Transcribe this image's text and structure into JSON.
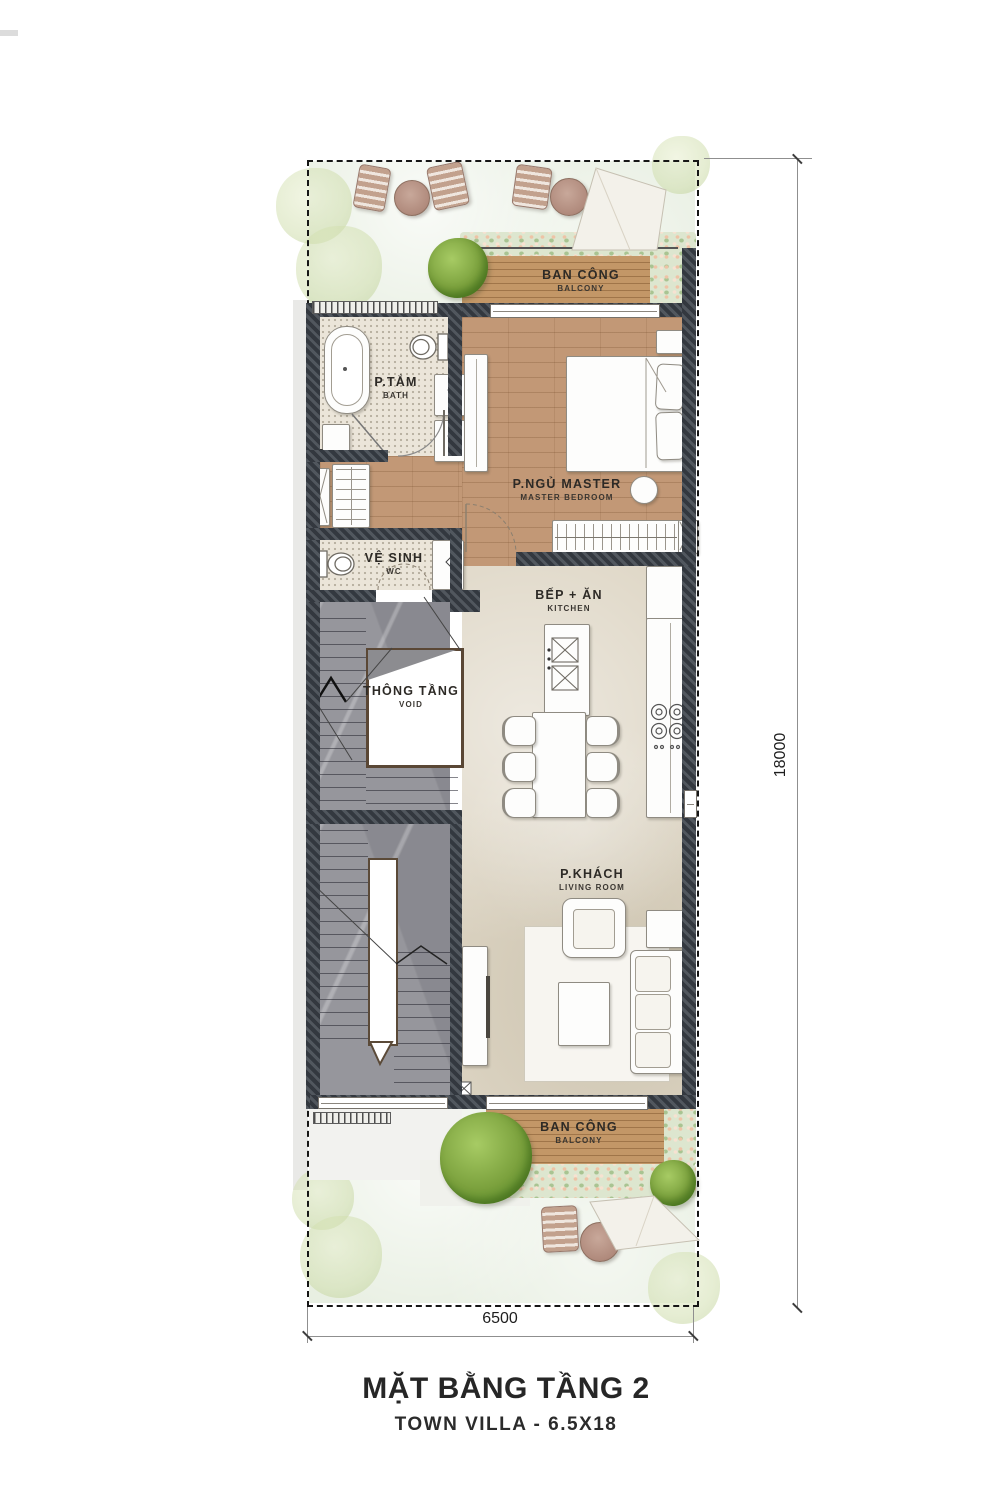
{
  "plan": {
    "title": "MẶT BẰNG TẦNG 2",
    "subtitle": "TOWN VILLA  - 6.5X18",
    "dim_width": "6500",
    "dim_height": "18000",
    "rooms": {
      "balcony_top": {
        "name": "BAN CÔNG",
        "name_en": "BALCONY"
      },
      "bath": {
        "name": "P.TẮM",
        "name_en": "BATH"
      },
      "master": {
        "name": "P.NGỦ MASTER",
        "name_en": "MASTER BEDROOM"
      },
      "wc": {
        "name": "VỆ SINH",
        "name_en": "WC"
      },
      "kitchen": {
        "name": "BẾP + ĂN",
        "name_en": "KITCHEN"
      },
      "void": {
        "name": "THÔNG TẦNG",
        "name_en": "VOID"
      },
      "living": {
        "name": "P.KHÁCH",
        "name_en": "LIVING ROOM"
      },
      "balcony_bottom": {
        "name": "BAN CÔNG",
        "name_en": "BALCONY"
      }
    },
    "colors": {
      "wall": "#3a4046",
      "wood_floor": "#c29876",
      "deck_wood": "#c39767",
      "stone_floor": "#ded6c5",
      "tile_floor": "#ebe5d9",
      "stair_marble": "#96969c",
      "garden": "#e8efe2",
      "tree": "#7ba13d",
      "label_text": "#2d2a26"
    }
  }
}
